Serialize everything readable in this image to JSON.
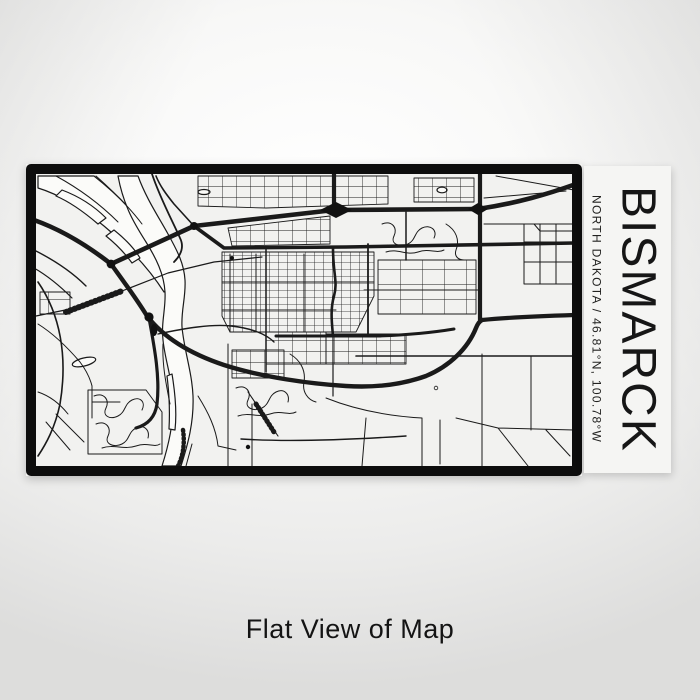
{
  "poster": {
    "city": "BISMARCK",
    "subtitle": "NORTH DAKOTA / 46.81°N, 100.78°W",
    "caption": "Flat View of Map"
  },
  "map": {
    "style": "black line street map",
    "features": [
      "missouri-river",
      "interstate-94",
      "downtown-grid",
      "expressway-loop",
      "railroad"
    ]
  },
  "colors": {
    "map_ink": "#1a1a1a",
    "map_paper": "#f2f2f0",
    "map_border": "#0d0d0d",
    "water": "#fbfbf9",
    "label_panel": "#f5f5f3",
    "backdrop_light": "#ffffff",
    "backdrop_dark": "#dddddc",
    "caption_text": "#141414"
  }
}
